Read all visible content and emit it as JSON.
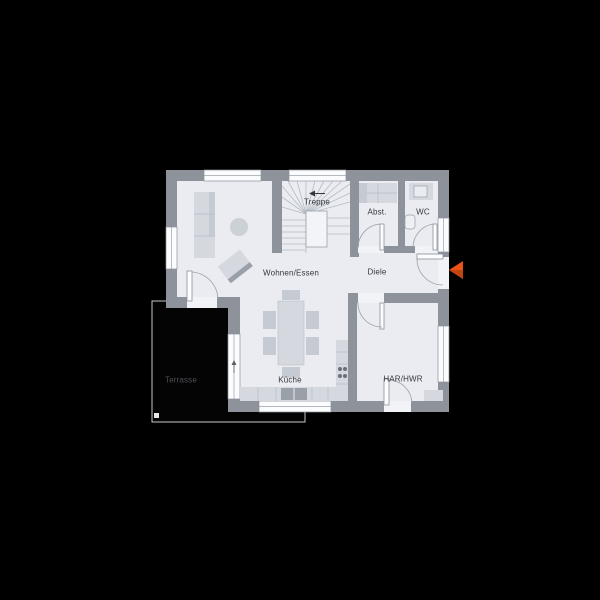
{
  "app": {
    "type": "architectural-floor-plan",
    "background_color": "#000000"
  },
  "floorplan": {
    "labels": {
      "treppe": "Treppe",
      "abst": "Abst.",
      "wc": "WC",
      "wohnen_essen": "Wohnen/Essen",
      "diele": "Diele",
      "kueche": "Küche",
      "har_hwr": "HAR/HWR",
      "terrasse": "Terrasse"
    },
    "icons": {
      "entrance_arrow": "orange left-pointing triangle at entry door",
      "stair_direction_arrow": "small left arrow above stair label",
      "window_marker": "small up-triangle marker on kitchen terrace window"
    },
    "colors": {
      "floor": "#eaecf1",
      "wall": "#8d929b",
      "furniture_light": "#d5d8df",
      "furniture_shade": "#b9bec7",
      "terrace_fill": "#040404",
      "terrace_outline": "#c9c9c9",
      "entrance_accent": "#ea5315",
      "label_text": "#34373c",
      "terrace_label_text": "#4e5157"
    }
  }
}
